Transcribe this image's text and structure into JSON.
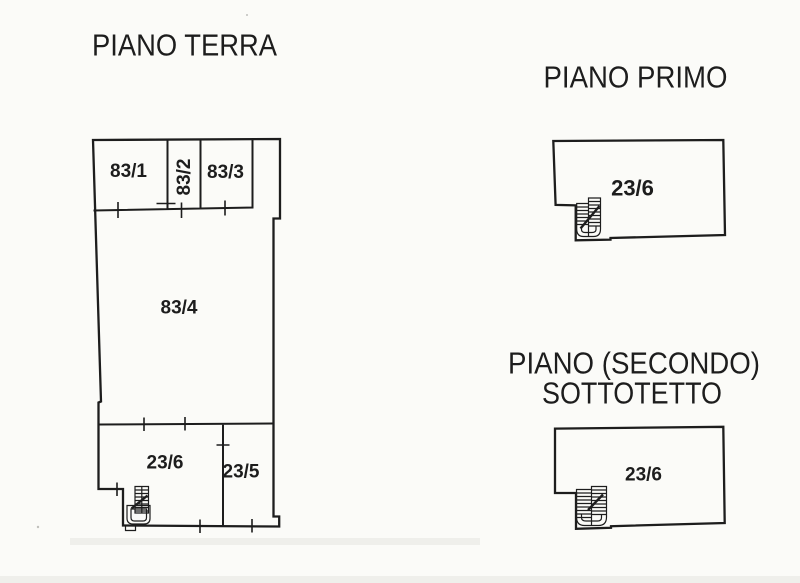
{
  "page": {
    "background": "#fbfbf8",
    "ink": "#1d1d1d",
    "kind": "scanned cadastral floor plan"
  },
  "plans": {
    "terra": {
      "title": "PIANO TERRA",
      "rooms": {
        "r1": "83/1",
        "r2": "83/2",
        "r3": "83/3",
        "r4": "83/4",
        "r5": "23/6",
        "r6": "23/5"
      }
    },
    "primo": {
      "title": "PIANO PRIMO",
      "rooms": {
        "r1": "23/6"
      }
    },
    "sottotetto": {
      "title_line1": "PIANO (SECONDO)",
      "title_line2": "SOTTOTETTO",
      "rooms": {
        "r1": "23/6"
      }
    }
  }
}
